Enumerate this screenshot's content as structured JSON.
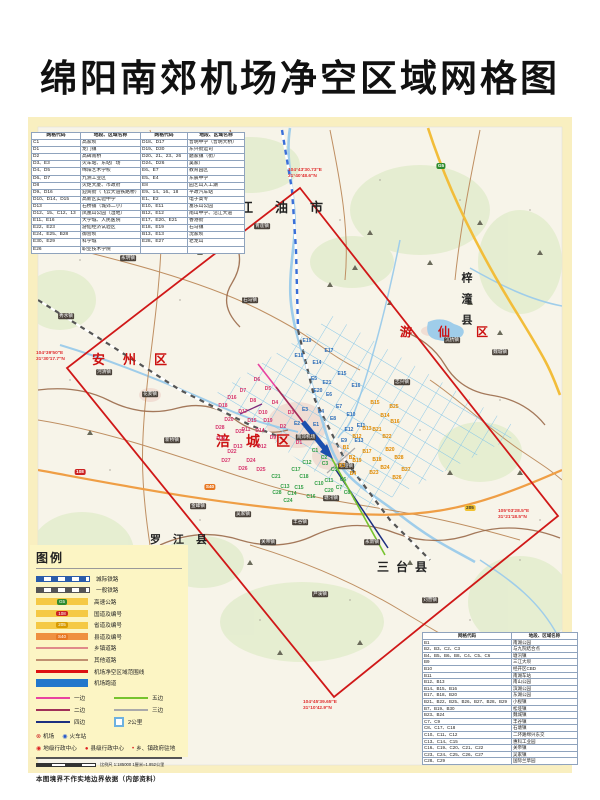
{
  "page_title": "绵阳南郊机场净空区域网格图",
  "tables": {
    "top_left": {
      "headers": [
        "网格代码",
        "地段、区域名称",
        "网格代码",
        "地段、区域名称"
      ],
      "rows": [
        [
          "C1",
          "高家坝",
          "D18、D17",
          "普明中学（普明大桥）"
        ],
        [
          "D1",
          "龙门镇",
          "D19、D30",
          "东兴街运司"
        ],
        [
          "D2",
          "高碑南桥",
          "D20、21、23、26",
          "磨家镇（街）"
        ],
        [
          "D3、E3",
          "火车站、东站广场",
          "D24、D26",
          "吴家厂"
        ],
        [
          "D4、D5",
          "绵阳艺术学校",
          "E6、E7",
          "教育园区"
        ],
        [
          "D6、D7",
          "九洲工业区",
          "E5、E4",
          "东辰中学"
        ],
        [
          "D8",
          "火炬大厦、市政府",
          "E8",
          "园艺山人工湖"
        ],
        [
          "D9、D16",
          "迎宾街（飞云大道铁路桥）",
          "E9、14、16、18",
          "平政汽车站"
        ],
        [
          "D10、D14、D15",
          "高新区实验中学",
          "E1、E2",
          "电子高专"
        ],
        [
          "D13",
          "石桥铺（城郊二小）",
          "E10、E11",
          "富乐山公园"
        ],
        [
          "D12、15、C12、13",
          "凤凰山公园（湿地）",
          "B12、E12",
          "南山中学、沿江大道"
        ],
        [
          "E11、E16",
          "大学城、人民医院",
          "E17、E20、E21",
          "香港街"
        ],
        [
          "E22、E23",
          "游仙经济试验区",
          "E18、E19",
          "石马镇"
        ],
        [
          "E24、E25、B28",
          "御营坝",
          "B13、E13",
          "沈家坝"
        ],
        [
          "E30、E29",
          "科学城",
          "E28、E27",
          "老龙山"
        ],
        [
          "E26",
          "职业技术学院",
          "",
          ""
        ]
      ]
    },
    "bottom_right": {
      "headers": [
        "网格代码",
        "地段、区域名称"
      ],
      "rows": [
        [
          "B1",
          "南湖公园"
        ],
        [
          "B2、B3、C2、C3",
          "与九院结合点"
        ],
        [
          "B4、B5、B6、B8、C4、C5、C6",
          "塘汛镇"
        ],
        [
          "B9",
          "三江大坝"
        ],
        [
          "B10",
          "经开区CBD"
        ],
        [
          "B11",
          "南湖车站"
        ],
        [
          "B12、B13",
          "南山公园"
        ],
        [
          "B14、B15、B16",
          "滨湖公园"
        ],
        [
          "B17、B18、B20",
          "东湖公园"
        ],
        [
          "B21、B22、B25、B26、B27、B28、B29",
          "小枧镇"
        ],
        [
          "B7、B19、B30",
          "松垭镇"
        ],
        [
          "B23、B24",
          "魏城镇"
        ],
        [
          "C7、C9",
          "丰谷镇"
        ],
        [
          "C8、C17、C18",
          "石塘镇"
        ],
        [
          "C10、C11、C12",
          "二环路绵兴东交"
        ],
        [
          "C13、C14、C15",
          "惠科工业园"
        ],
        [
          "C16、C19、C20、C21、C22",
          "关帝镇"
        ],
        [
          "C23、C24、C25、C26、C27",
          "吴家镇"
        ],
        [
          "C28、C29",
          "国际兰草园"
        ]
      ]
    }
  },
  "legend": {
    "title": "图例",
    "line_items": [
      {
        "label": "城际铁路",
        "type": "sw-rail-blue"
      },
      {
        "label": "一般铁路",
        "type": "sw-rail-gray"
      },
      {
        "label": "高速公路",
        "type": "sw-hwy",
        "badge": "G5",
        "badge_color": "#2e8b2e"
      },
      {
        "label": "国道及编号",
        "type": "sw-hwy",
        "badge": "108",
        "badge_color": "#cc2222"
      },
      {
        "label": "省道及编号",
        "type": "sw-hwy",
        "badge": "205",
        "badge_color": "#d89b00"
      },
      {
        "label": "县道及编号",
        "type": "sw-county",
        "badge": "S40",
        "badge_color": "#e87722"
      },
      {
        "label": "乡镇道路",
        "type": "sw-line",
        "color": "#e08a8a"
      },
      {
        "label": "其他道路",
        "type": "sw-line",
        "color": "#c09070"
      },
      {
        "label": "机场净空区域范围线",
        "type": "sw-line-thick",
        "color": "#dd1111"
      },
      {
        "label": "机场跑道",
        "type": "sw-bar",
        "color": "#2277cc"
      }
    ],
    "pattern_items": [
      {
        "label": "一边",
        "color": "#e843a0"
      },
      {
        "label": "五边",
        "color": "#76c32e"
      },
      {
        "label": "二边",
        "color": "#a03058"
      },
      {
        "label": "三边",
        "color": "#aaaaaa"
      },
      {
        "label": "四边",
        "color": "#1c2f80"
      },
      {
        "label": "2公里",
        "square": true
      }
    ],
    "symbols_row1": [
      {
        "glyph": "⊗",
        "color": "#cc2222",
        "label": "机场"
      },
      {
        "glyph": "◉",
        "color": "#2255cc",
        "label": "火车站"
      }
    ],
    "symbols_row2": [
      {
        "glyph": "◉",
        "color": "#dd2222",
        "label": "地级行政中心"
      },
      {
        "glyph": "●",
        "color": "#dd2222",
        "label": "县级行政中心"
      },
      {
        "glyph": "•",
        "color": "#dd2222",
        "label": "乡、镇政府驻地"
      }
    ],
    "scale_text": "比例尺 1:185000 1厘米=1.852公里",
    "disclaimer": "本图境界不作实地边界依据（内部资料）"
  },
  "districts": [
    {
      "name": "江油市",
      "x": 240,
      "y": 197,
      "color": "#222222",
      "size": 13,
      "ls": 22,
      "vert": false
    },
    {
      "name": "安州区",
      "x": 92,
      "y": 349,
      "color": "#cc1111",
      "size": 13,
      "ls": 18,
      "vert": false
    },
    {
      "name": "游仙区",
      "x": 400,
      "y": 323,
      "color": "#cc1111",
      "size": 12,
      "ls": 26,
      "vert": false
    },
    {
      "name": "涪城区",
      "x": 216,
      "y": 431,
      "color": "#cc1111",
      "size": 14,
      "ls": 16,
      "vert": false
    },
    {
      "name": "梓潼县",
      "x": 458,
      "y": 272,
      "color": "#222222",
      "size": 11,
      "ls": 10,
      "vert": true
    },
    {
      "name": "罗江县",
      "x": 150,
      "y": 531,
      "color": "#222222",
      "size": 11,
      "ls": 12,
      "vert": false
    },
    {
      "name": "三台县",
      "x": 377,
      "y": 558,
      "color": "#222222",
      "size": 12,
      "ls": 7,
      "vert": false
    }
  ],
  "corner_coords": [
    {
      "line1": "104°43′30.73″E",
      "line2": "31°40′48.6″N",
      "x": 288,
      "y": 168
    },
    {
      "line1": "104°39′50″E",
      "line2": "31°30′17.7″N",
      "x": 36,
      "y": 351
    },
    {
      "line1": "105°03′28.5″E",
      "line2": "31°21′18.5″N",
      "x": 498,
      "y": 509
    },
    {
      "line1": "104°45′39.65″E",
      "line2": "31°10′42.9″N",
      "x": 303,
      "y": 700
    }
  ],
  "towns": [
    {
      "name": "青莲镇",
      "x": 262,
      "y": 226
    },
    {
      "name": "永明镇",
      "x": 128,
      "y": 258
    },
    {
      "name": "秀水镇",
      "x": 66,
      "y": 316
    },
    {
      "name": "河清镇",
      "x": 104,
      "y": 372
    },
    {
      "name": "花荄镇",
      "x": 150,
      "y": 394
    },
    {
      "name": "新桥镇",
      "x": 172,
      "y": 440
    },
    {
      "name": "石马镇",
      "x": 250,
      "y": 300
    },
    {
      "name": "忠兴镇",
      "x": 402,
      "y": 382
    },
    {
      "name": "沉抗镇",
      "x": 452,
      "y": 340
    },
    {
      "name": "魏城镇",
      "x": 500,
      "y": 352
    },
    {
      "name": "松垭镇",
      "x": 346,
      "y": 466
    },
    {
      "name": "南郊机场",
      "x": 306,
      "y": 437
    },
    {
      "name": "塘汛镇",
      "x": 331,
      "y": 498
    },
    {
      "name": "丰谷镇",
      "x": 300,
      "y": 522
    },
    {
      "name": "金峰镇",
      "x": 198,
      "y": 506
    },
    {
      "name": "吴家镇",
      "x": 243,
      "y": 514
    },
    {
      "name": "关帝镇",
      "x": 268,
      "y": 542
    },
    {
      "name": "芦溪镇",
      "x": 320,
      "y": 594
    },
    {
      "name": "永新镇",
      "x": 372,
      "y": 542
    },
    {
      "name": "刘营镇",
      "x": 430,
      "y": 600
    }
  ],
  "road_shields": [
    {
      "text": "G5",
      "x": 441,
      "y": 166,
      "bg": "#2e8b2e",
      "fg": "#ffffff"
    },
    {
      "text": "108",
      "x": 80,
      "y": 472,
      "bg": "#cc2222",
      "fg": "#ffffff"
    },
    {
      "text": "205",
      "x": 470,
      "y": 508,
      "bg": "#f2c230",
      "fg": "#333333"
    },
    {
      "text": "S40",
      "x": 210,
      "y": 487,
      "bg": "#e87722",
      "fg": "#ffffff"
    }
  ],
  "grid_labels": {
    "colors": {
      "D": "#d6336c",
      "E": "#2b6cb8",
      "B": "#e08a00",
      "C": "#2f9e44"
    },
    "cells": [
      {
        "code": "D5",
        "x": 268,
        "y": 389
      },
      {
        "code": "D6",
        "x": 257,
        "y": 380
      },
      {
        "code": "D7",
        "x": 243,
        "y": 391
      },
      {
        "code": "D8",
        "x": 253,
        "y": 401
      },
      {
        "code": "D16",
        "x": 232,
        "y": 398
      },
      {
        "code": "D17",
        "x": 243,
        "y": 412
      },
      {
        "code": "D18",
        "x": 223,
        "y": 406
      },
      {
        "code": "D19",
        "x": 268,
        "y": 421
      },
      {
        "code": "D15",
        "x": 252,
        "y": 421
      },
      {
        "code": "D11",
        "x": 246,
        "y": 430
      },
      {
        "code": "D14",
        "x": 260,
        "y": 431
      },
      {
        "code": "D1",
        "x": 299,
        "y": 443
      },
      {
        "code": "D2",
        "x": 283,
        "y": 427
      },
      {
        "code": "D3",
        "x": 291,
        "y": 413
      },
      {
        "code": "D4",
        "x": 275,
        "y": 403
      },
      {
        "code": "D10",
        "x": 263,
        "y": 413
      },
      {
        "code": "D9",
        "x": 273,
        "y": 438
      },
      {
        "code": "D12",
        "x": 262,
        "y": 447
      },
      {
        "code": "D13",
        "x": 238,
        "y": 447
      },
      {
        "code": "D20",
        "x": 229,
        "y": 420
      },
      {
        "code": "D21",
        "x": 221,
        "y": 439
      },
      {
        "code": "D23",
        "x": 240,
        "y": 432
      },
      {
        "code": "D25",
        "x": 261,
        "y": 470
      },
      {
        "code": "D24",
        "x": 251,
        "y": 461
      },
      {
        "code": "D26",
        "x": 243,
        "y": 469
      },
      {
        "code": "D27",
        "x": 226,
        "y": 461
      },
      {
        "code": "D28",
        "x": 220,
        "y": 428
      },
      {
        "code": "D22",
        "x": 232,
        "y": 452
      },
      {
        "code": "E19",
        "x": 307,
        "y": 341
      },
      {
        "code": "E17",
        "x": 329,
        "y": 351
      },
      {
        "code": "E14",
        "x": 317,
        "y": 363
      },
      {
        "code": "E15",
        "x": 342,
        "y": 374
      },
      {
        "code": "E5",
        "x": 314,
        "y": 379
      },
      {
        "code": "E16",
        "x": 356,
        "y": 386
      },
      {
        "code": "E7",
        "x": 339,
        "y": 407
      },
      {
        "code": "E6",
        "x": 329,
        "y": 395
      },
      {
        "code": "E12",
        "x": 349,
        "y": 430
      },
      {
        "code": "E1",
        "x": 316,
        "y": 425
      },
      {
        "code": "E2",
        "x": 297,
        "y": 424
      },
      {
        "code": "E3",
        "x": 305,
        "y": 410
      },
      {
        "code": "E4",
        "x": 321,
        "y": 412
      },
      {
        "code": "E8",
        "x": 333,
        "y": 419
      },
      {
        "code": "E9",
        "x": 344,
        "y": 441
      },
      {
        "code": "E13",
        "x": 359,
        "y": 441
      },
      {
        "code": "E10",
        "x": 351,
        "y": 415
      },
      {
        "code": "E11",
        "x": 361,
        "y": 426
      },
      {
        "code": "E18",
        "x": 299,
        "y": 356
      },
      {
        "code": "E20",
        "x": 318,
        "y": 391
      },
      {
        "code": "E21",
        "x": 327,
        "y": 383
      },
      {
        "code": "B15",
        "x": 375,
        "y": 403
      },
      {
        "code": "B14",
        "x": 385,
        "y": 416
      },
      {
        "code": "B25",
        "x": 394,
        "y": 407
      },
      {
        "code": "B16",
        "x": 395,
        "y": 422
      },
      {
        "code": "B22",
        "x": 387,
        "y": 437
      },
      {
        "code": "B21",
        "x": 377,
        "y": 430
      },
      {
        "code": "B13",
        "x": 367,
        "y": 429
      },
      {
        "code": "B12",
        "x": 357,
        "y": 437
      },
      {
        "code": "B17",
        "x": 367,
        "y": 452
      },
      {
        "code": "B18",
        "x": 377,
        "y": 460
      },
      {
        "code": "B19",
        "x": 357,
        "y": 461
      },
      {
        "code": "B23",
        "x": 374,
        "y": 473
      },
      {
        "code": "B24",
        "x": 385,
        "y": 468
      },
      {
        "code": "B20",
        "x": 390,
        "y": 450
      },
      {
        "code": "B26",
        "x": 397,
        "y": 478
      },
      {
        "code": "B27",
        "x": 406,
        "y": 470
      },
      {
        "code": "B28",
        "x": 399,
        "y": 458
      },
      {
        "code": "B1",
        "x": 346,
        "y": 448
      },
      {
        "code": "B2",
        "x": 352,
        "y": 458
      },
      {
        "code": "B3",
        "x": 342,
        "y": 466
      },
      {
        "code": "B4",
        "x": 353,
        "y": 474
      },
      {
        "code": "C1",
        "x": 315,
        "y": 451
      },
      {
        "code": "C2",
        "x": 324,
        "y": 458
      },
      {
        "code": "C3",
        "x": 325,
        "y": 464
      },
      {
        "code": "C5",
        "x": 334,
        "y": 470
      },
      {
        "code": "C18",
        "x": 304,
        "y": 477
      },
      {
        "code": "C21",
        "x": 276,
        "y": 477
      },
      {
        "code": "C10",
        "x": 319,
        "y": 484
      },
      {
        "code": "C15",
        "x": 299,
        "y": 488
      },
      {
        "code": "C13",
        "x": 285,
        "y": 487
      },
      {
        "code": "C14",
        "x": 292,
        "y": 494
      },
      {
        "code": "C16",
        "x": 311,
        "y": 497
      },
      {
        "code": "C20",
        "x": 329,
        "y": 491
      },
      {
        "code": "C24",
        "x": 288,
        "y": 501
      },
      {
        "code": "C28",
        "x": 277,
        "y": 493
      },
      {
        "code": "C7",
        "x": 339,
        "y": 488
      },
      {
        "code": "C17",
        "x": 296,
        "y": 470
      },
      {
        "code": "C11",
        "x": 329,
        "y": 481
      },
      {
        "code": "C6",
        "x": 343,
        "y": 480
      },
      {
        "code": "C8",
        "x": 347,
        "y": 493
      },
      {
        "code": "C12",
        "x": 307,
        "y": 463
      }
    ]
  }
}
